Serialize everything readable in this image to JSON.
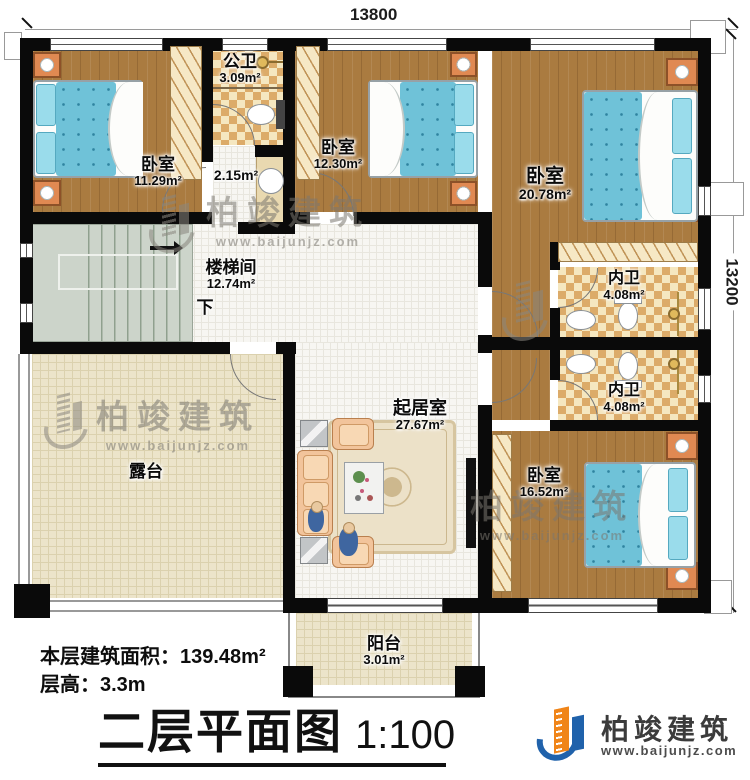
{
  "dimensions": {
    "width": "13800",
    "height": "13200"
  },
  "rooms": {
    "bedroom1": {
      "name": "卧室",
      "area": "11.29m²"
    },
    "public_bath": {
      "name": "公卫",
      "area": "3.09m²"
    },
    "vestibule": {
      "area": "2.15m²"
    },
    "bedroom2": {
      "name": "卧室",
      "area": "12.30m²"
    },
    "bedroom3": {
      "name": "卧室",
      "area": "20.78m²"
    },
    "stairwell": {
      "name": "楼梯间",
      "area": "12.74m²",
      "down": "下"
    },
    "inner_bath_1": {
      "name": "内卫",
      "area": "4.08m²"
    },
    "inner_bath_2": {
      "name": "内卫",
      "area": "4.08m²"
    },
    "living_room": {
      "name": "起居室",
      "area": "27.67m²"
    },
    "terrace": {
      "name": "露台"
    },
    "bedroom4": {
      "name": "卧室",
      "area": "16.52m²"
    },
    "balcony": {
      "name": "阳台",
      "area": "3.01m²"
    }
  },
  "footer": {
    "building_area": "本层建筑面积：139.48m²",
    "floor_height": "层高：3.3m",
    "title": "二层平面图",
    "scale": "1:100"
  },
  "brand": {
    "name": "柏竣建筑",
    "website": "www.baijunjz.com"
  },
  "watermark": {
    "name": "柏竣建筑",
    "website": "www.baijunjz.com"
  },
  "colors": {
    "wall": "#0a0a0a",
    "wood": "#aa7b40",
    "mattress": "#6fc2d8",
    "bath_checker": "#dcab69",
    "terrace": "#ece4ca",
    "stair": "#ccd4ca",
    "brand_blue": "#2062ab",
    "brand_orange": "#f08519"
  }
}
